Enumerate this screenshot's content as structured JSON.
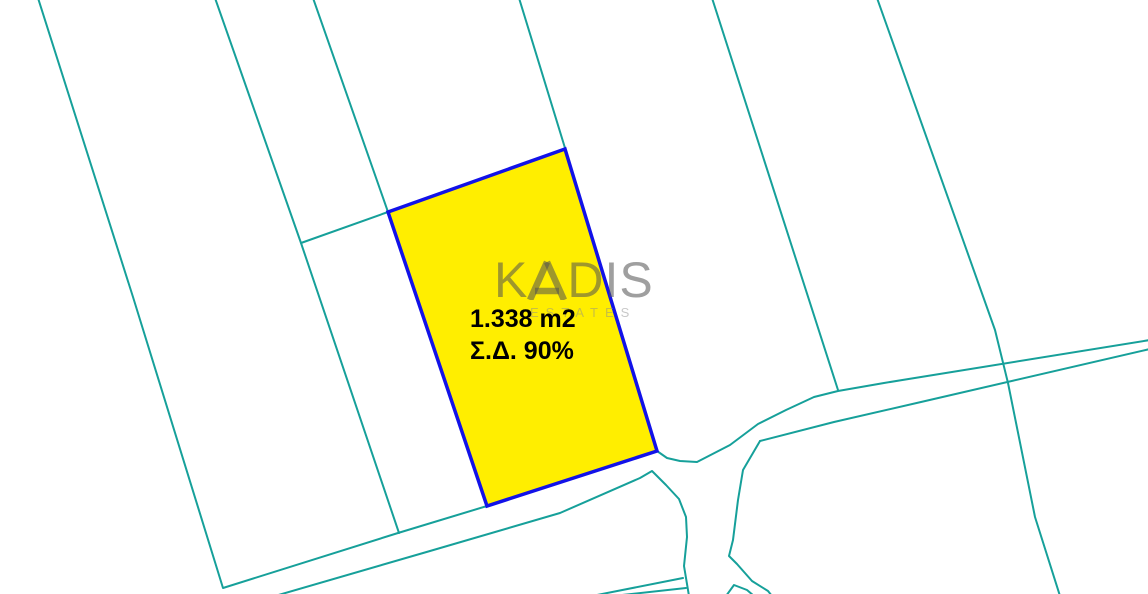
{
  "map": {
    "type": "cadastral-plan",
    "background": "#FFFFFF",
    "colors": {
      "boundary_teal": "#16A09A",
      "parcel_border_blue": "#1212E8",
      "parcel_fill_yellow": "#FFEE00",
      "watermark_gray": "#9F9F9F",
      "label_black": "#000000"
    }
  },
  "parcel": {
    "area_label": "1.338 m2",
    "density_label": "Σ.Δ. 90%",
    "highlighted": true
  },
  "watermark": {
    "brand_full": "KADIS",
    "brand_prefix": "K",
    "brand_suffix": "DIS",
    "stylized_letter": "A (triangle glyph)",
    "tagline": "ESTATES"
  }
}
